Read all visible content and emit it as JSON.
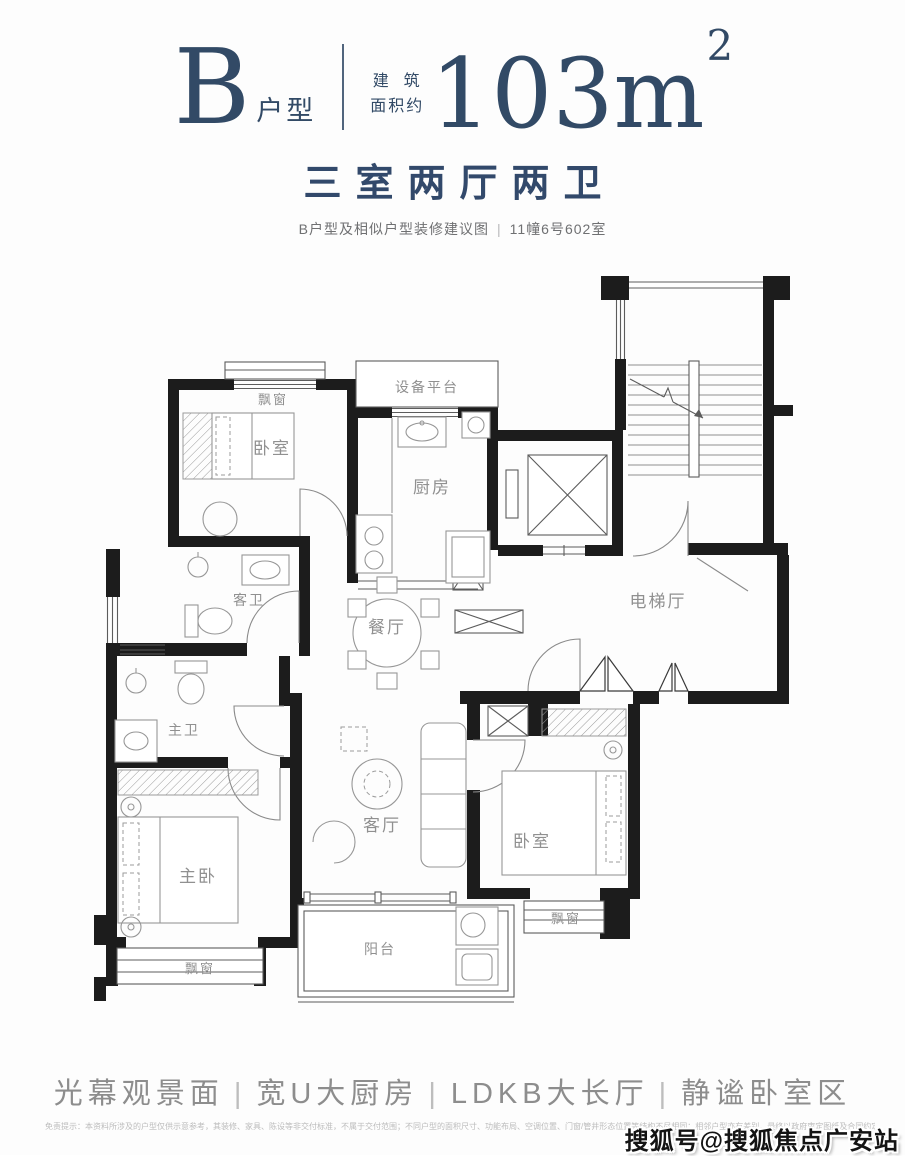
{
  "header": {
    "unit_letter": "B",
    "unit_suffix": "户型",
    "area_prefix_line1": "建  筑",
    "area_prefix_line2": "面积约",
    "area_value": "103m",
    "area_sup": "2",
    "layout_title": "三室两厅两卫",
    "subtitle_left": "B户型及相似户型装修建议图",
    "subtitle_divider": "|",
    "subtitle_right": "11幢6号602室"
  },
  "plan": {
    "rooms": {
      "bay_tl": "飘窗",
      "bedroom_tl": "卧室",
      "equip": "设备平台",
      "kitchen": "厨房",
      "guest_bath": "客卫",
      "dining": "餐厅",
      "elev_hall": "电梯厅",
      "master_bath": "主卫",
      "master_bed": "主卧",
      "living": "客厅",
      "bedroom_r": "卧室",
      "bay_bl": "飘窗",
      "bay_br": "飘窗",
      "balcony": "阳台"
    }
  },
  "footer": {
    "tagline": [
      "光幕观景面",
      "宽U大厨房",
      "LDKB大长厅",
      "静谧卧室区"
    ],
    "tagline_divider": "|",
    "disclaimer": "免责提示：本资料所涉及的户型仅供示意参考，其装修、家具、陈设等非交付标准，不属于交付范围；不同户型的面积尺寸、功能布局、空调位置、门窗/管井形态位置等结构不尽相同；相邻户型亦有差别，最终以政府审定图纸及合同约定为准。",
    "watermark": "搜狐号@搜狐焦点广安站"
  },
  "colors": {
    "navy": "#324a66",
    "wall": "#1c1c1c",
    "label_gray": "#909090",
    "tagline_gray": "#8d8d8d"
  }
}
